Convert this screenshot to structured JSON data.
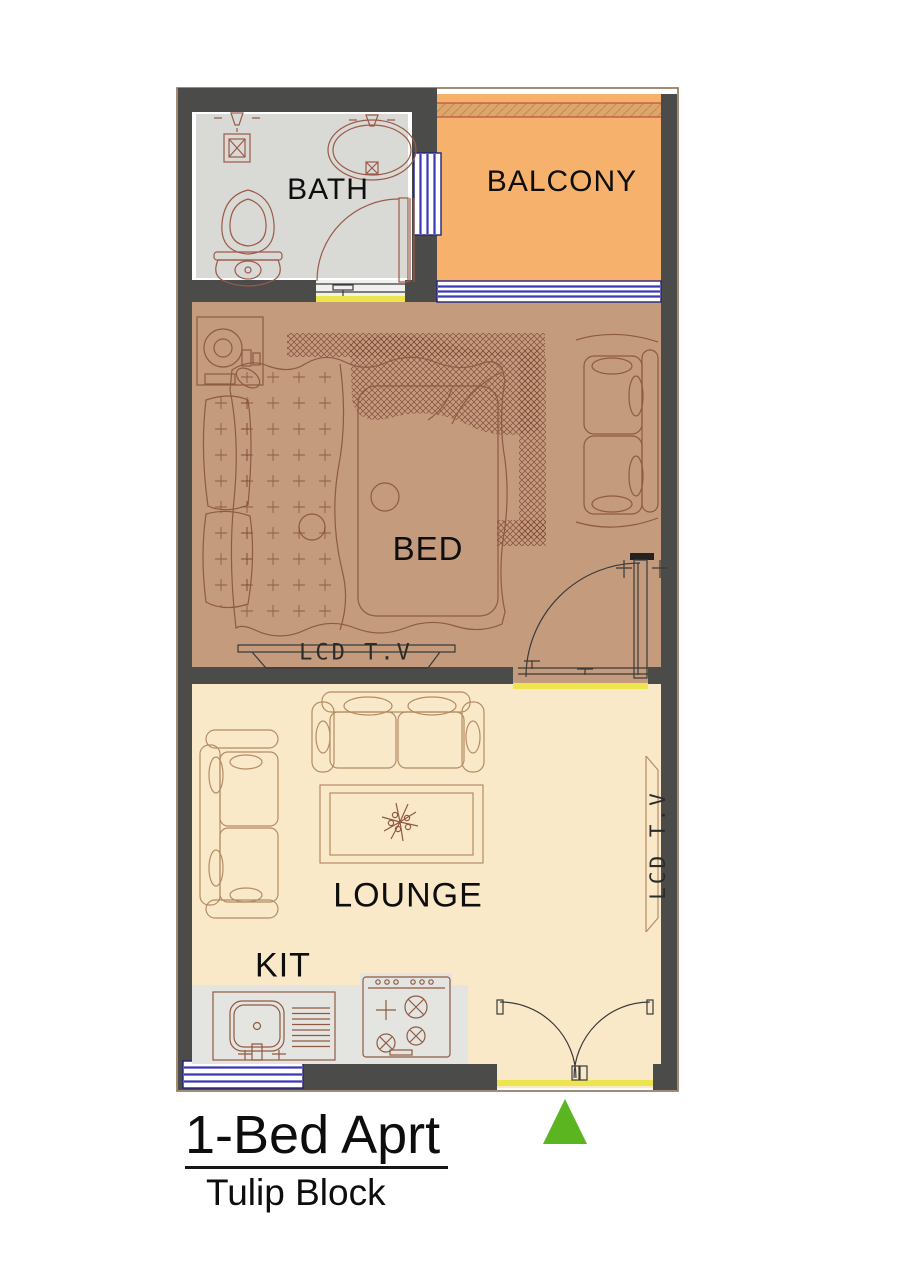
{
  "plan": {
    "rooms": [
      {
        "id": "bath",
        "label": "BATH"
      },
      {
        "id": "balcony",
        "label": "BALCONY"
      },
      {
        "id": "bed",
        "label": "BED"
      },
      {
        "id": "lounge",
        "label": "LOUNGE"
      },
      {
        "id": "kitchen",
        "label": "KIT"
      }
    ],
    "fixtures": {
      "bed_tv_label": "LCD T.V",
      "lounge_tv_label": "LCD T.V"
    }
  },
  "title_block": {
    "title": "1-Bed Aprt",
    "subtitle": "Tulip Block"
  },
  "icons": {
    "north_arrow": "green-triangle"
  },
  "colors": {
    "wall": "#4b4b49",
    "outline": "#8a7054",
    "bath_floor": "#d9d9d6",
    "balcony_floor": "#f6b16c",
    "balcony_band": "#dda66a",
    "band_line": "#c0504d",
    "bed_floor": "#c49b7d",
    "lounge_floor": "#f9e9c9",
    "counter_grey": "#e4e4e1",
    "window_blue": "#3a3ab5",
    "window_frame": "#23237e",
    "threshold_yellow": "#ece54e",
    "line_bath": "#9b5a48",
    "line_bed": "#8f5a43",
    "line_lounge": "#b58c64",
    "north_green": "#5ab520"
  }
}
